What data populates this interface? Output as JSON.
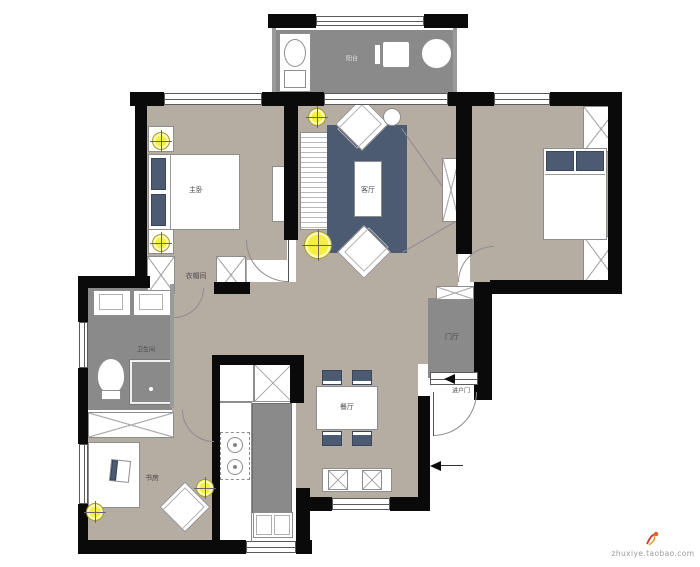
{
  "rooms": {
    "master_bedroom": "主卧",
    "living_room": "客厅",
    "dining_room": "餐厅",
    "bathroom": "卫生间",
    "closet": "衣帽间",
    "foyer": "门厅",
    "study": "书房",
    "balcony": "阳台"
  },
  "annotations": {
    "entry_door": "进户门",
    "watermark": "zhuxiye.taobao.com"
  },
  "colors": {
    "wall": "#0a0a0a",
    "floor": "#b5aca2",
    "wet_floor": "#8a8a8a",
    "accent_blue": "#4c5b72",
    "light_yellow": "#f6ef3d"
  }
}
